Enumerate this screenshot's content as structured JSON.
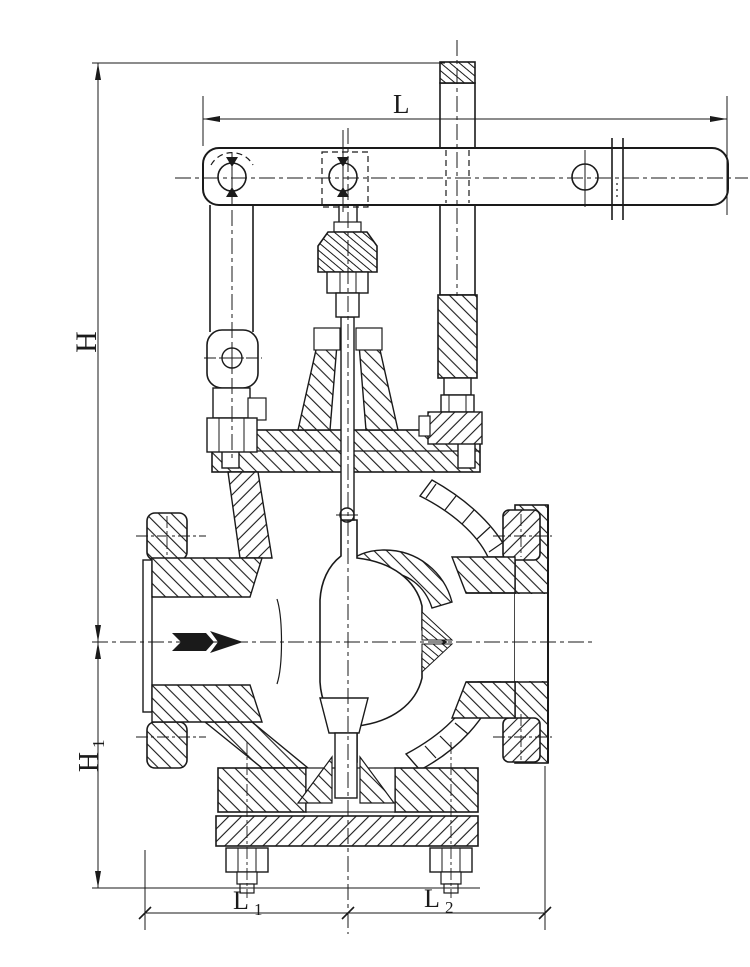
{
  "drawing": {
    "background_color": "#ffffff",
    "line_color": "#1a1a1a",
    "labels": {
      "L": {
        "text": "L"
      },
      "H": {
        "text": "H"
      },
      "H1": {
        "main": "H",
        "sub": "1"
      },
      "L1": {
        "main": "L",
        "sub": "1"
      },
      "L2": {
        "main": "L",
        "sub": "2"
      }
    },
    "flow_arrow": {
      "direction": "right"
    }
  }
}
